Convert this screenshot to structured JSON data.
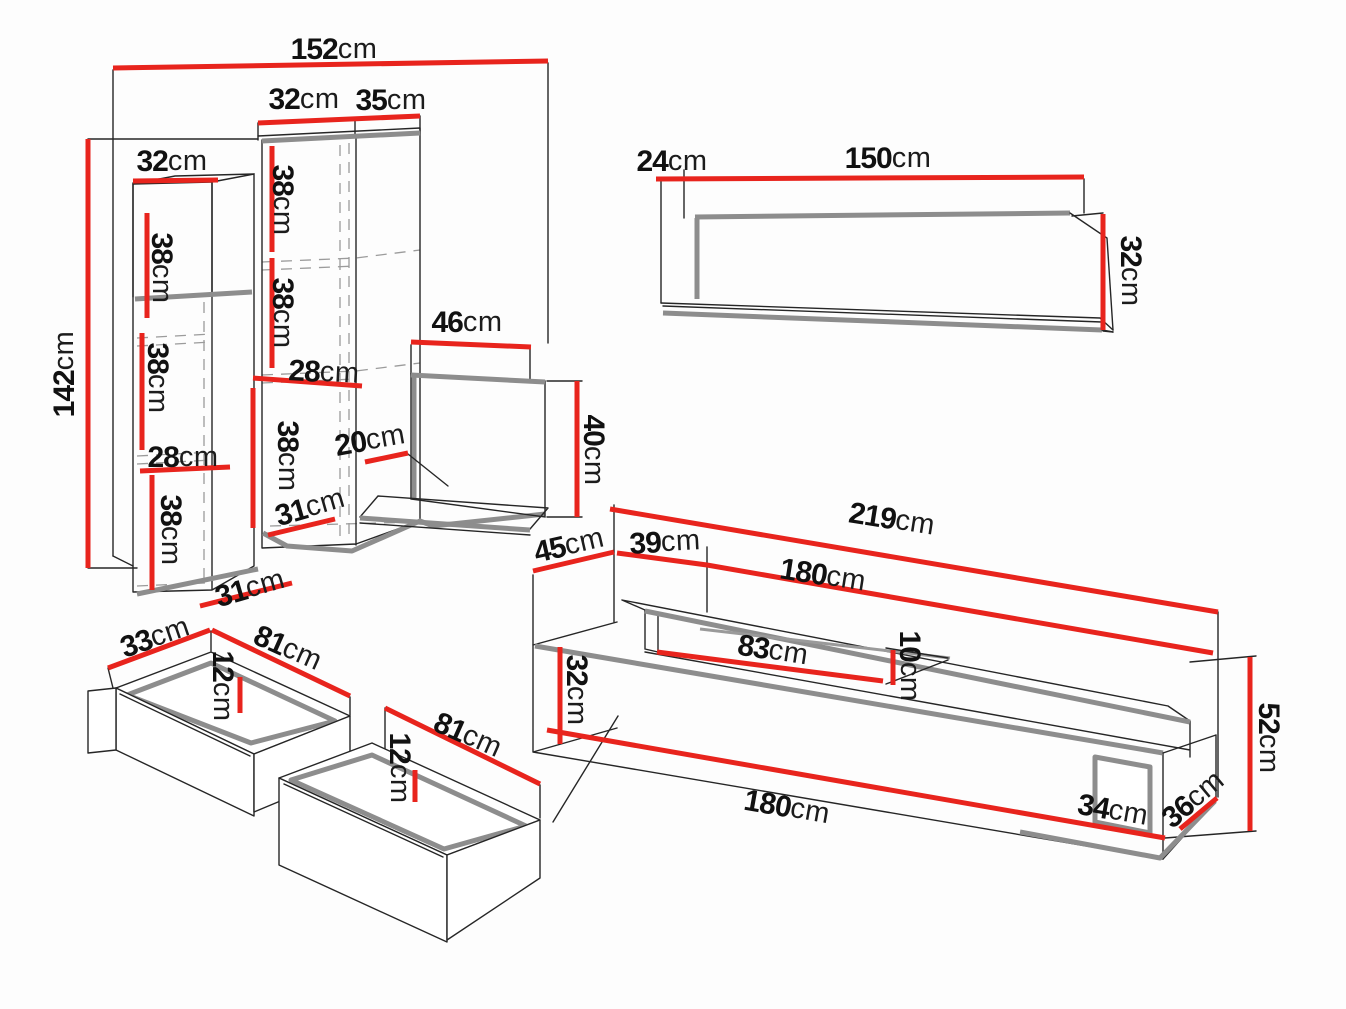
{
  "diagram": {
    "title": "furniture-set-dimension-diagram",
    "unit": "cm",
    "colors": {
      "dimension_line": "#e8241d",
      "outline": "#262626",
      "panel_edge": "#8d8d8d",
      "background": "#fdfdfd",
      "text": "#111111"
    },
    "pieces": {
      "wall_unit": {
        "dims": {
          "total_width": "152",
          "top_left_width": "32",
          "top_right_width": "35",
          "left_top_width": "32",
          "mid_shelf_1": "38",
          "left_shelf_1": "38",
          "mid_shelf_2": "38",
          "left_shelf_2": "38",
          "mid_inner_width": "28",
          "mid_shelf_3": "38",
          "left_inner_width": "28",
          "desk_depth": "20",
          "left_shelf_3": "38",
          "mid_depth": "31",
          "left_depth": "31",
          "total_height": "142",
          "top_shelf_width": "46",
          "panel_height": "40"
        }
      },
      "wall_shelf": {
        "dims": {
          "depth": "24",
          "width": "150",
          "height": "32"
        }
      },
      "tv_stand": {
        "dims": {
          "total_width": "219",
          "left_depth": "45",
          "top_depth": "39",
          "top_width": "180",
          "niche_width": "83",
          "niche_height": "10",
          "front_height": "32",
          "front_width": "180",
          "opening_width": "34",
          "right_depth": "36",
          "total_height": "52"
        }
      },
      "drawers": {
        "dims": {
          "drawer1_depth": "33",
          "drawer1_width": "81",
          "drawer1_height": "12",
          "drawer2_width": "81",
          "drawer2_height": "12"
        }
      }
    }
  }
}
